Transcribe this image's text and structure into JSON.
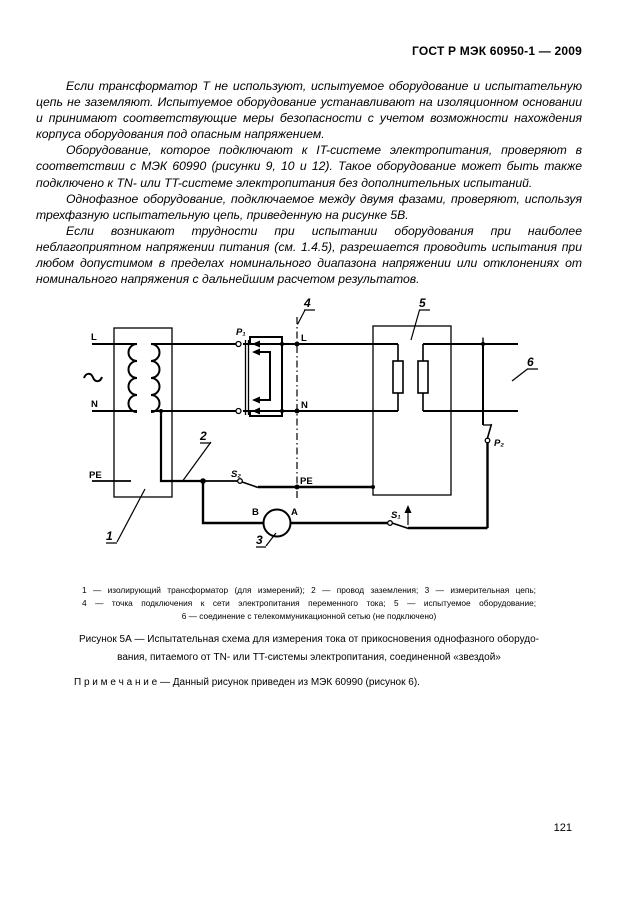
{
  "header": {
    "doc_number": "ГОСТ Р МЭК 60950-1 — 2009"
  },
  "body": {
    "paragraphs": [
      "Если трансформатор Т не используют, испытуемое оборудование и испытательную цепь не заземляют. Испытуемое оборудование устанавливают на изоляционном основании и принимают соответствующие меры безопасности с учетом возможности нахождения корпуса оборудования под опасным напряжением.",
      "Оборудование, которое подключают к IT-системе электропитания, проверяют в соответствии с МЭК 60990 (рисунки 9, 10 и 12). Такое оборудование может быть также подключено к TN- или TT-системе электропитания без дополнительных испытаний.",
      "Однофазное оборудование, подключаемое между двумя фазами, проверяют, используя трехфазную испытательную цепь, приведенную на рисунке 5В.",
      "Если возникают трудности при испытании оборудования при наиболее неблагоприятном напряжении питания (см. 1.4.5), разрешается проводить испытания при любом допустимом в пределах номинального диапазона напряжении или отклонениях от номинального напряжения с дальнейшим расчетом результатов."
    ]
  },
  "figure": {
    "labels": {
      "l_left": "L",
      "n_left": "N",
      "pe_left": "PE",
      "p1": "P₁",
      "l_right": "L",
      "n_right": "N",
      "pe_right": "PE",
      "s2": "S₂",
      "b": "B",
      "a": "A",
      "s1": "S₁",
      "p2": "P₂",
      "callout_1": "1",
      "callout_2": "2",
      "callout_3": "3",
      "callout_4": "4",
      "callout_5": "5",
      "callout_6": "6"
    },
    "legend_lines": [
      "1 — изолирующий трансформатор (для измерений); 2 — провод заземления; 3 — измерительная цепь;",
      "4 — точка подключения к сети электропитания переменного тока; 5 — испытуемое оборудование;",
      "6 — соединение с телекоммуникационной сетью (не подключено)"
    ],
    "caption_line1": "Рисунок 5А — Испытательная схема для измерения тока от прикосновения однофазного оборудо-",
    "caption_line2": "вания, питаемого от TN- или TT-системы электропитания, соединенной «звездой»",
    "note": "П р и м е ч а н и е — Данный рисунок приведен из МЭК 60990 (рисунок 6)."
  },
  "footer": {
    "page_number": "121"
  }
}
